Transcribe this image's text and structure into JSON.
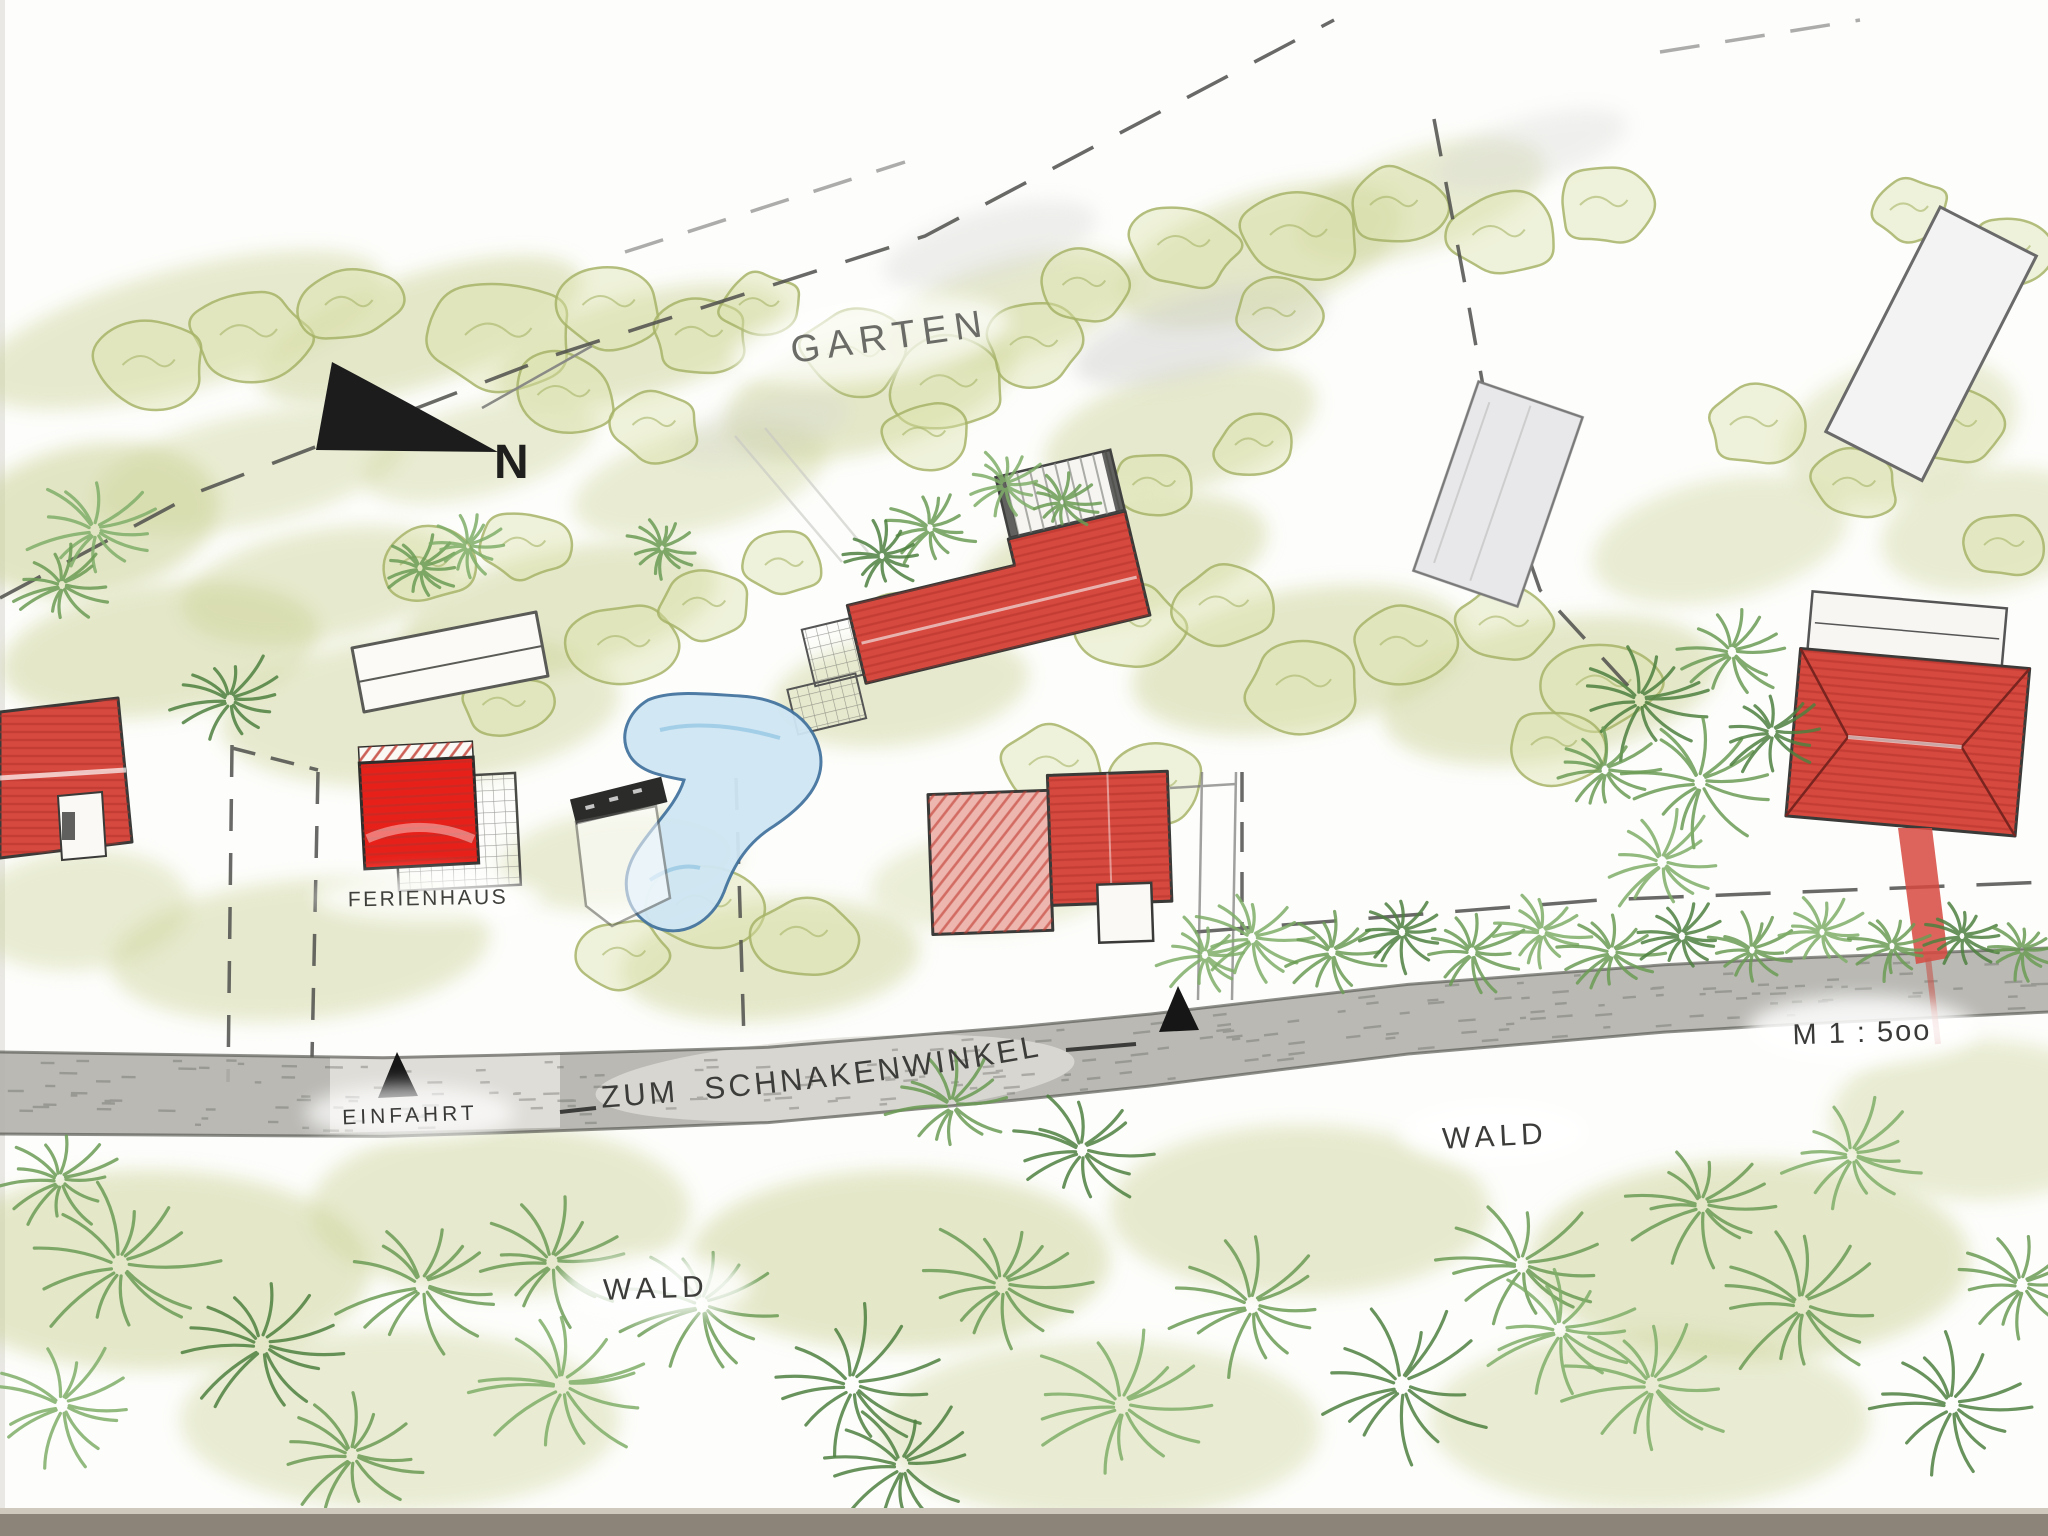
{
  "plan": {
    "labels": {
      "garten": "GARTEN",
      "north": "N",
      "ferienhaus": "FERIENHAUS",
      "einfahrt": "EINFAHRT",
      "street": "ZUM SCHNAKENWINKEL",
      "scale": "M 1 : 5oo",
      "wald_right": "WALD",
      "wald_left": "WALD"
    },
    "palette": {
      "paper": "#fdfdfb",
      "ink": "#3c3c3a",
      "house_red": "#d6493f",
      "house_red_bright": "#e8201a",
      "house_red_pale": "#edb7b0",
      "pond_fill": "#cfe6f4",
      "pond_edge": "#44749f",
      "road_fill": "#b2b1ac",
      "road_edge": "#55544f",
      "foliage_dark": "#4e8040",
      "foliage_mid": "#6b9b55",
      "foliage_light": "#7fae69",
      "shrub_fill": "#dde3ad",
      "shrub_edge": "#a7b468",
      "shade_olive": "#ccd397",
      "scan_band": "#8c8478"
    }
  }
}
